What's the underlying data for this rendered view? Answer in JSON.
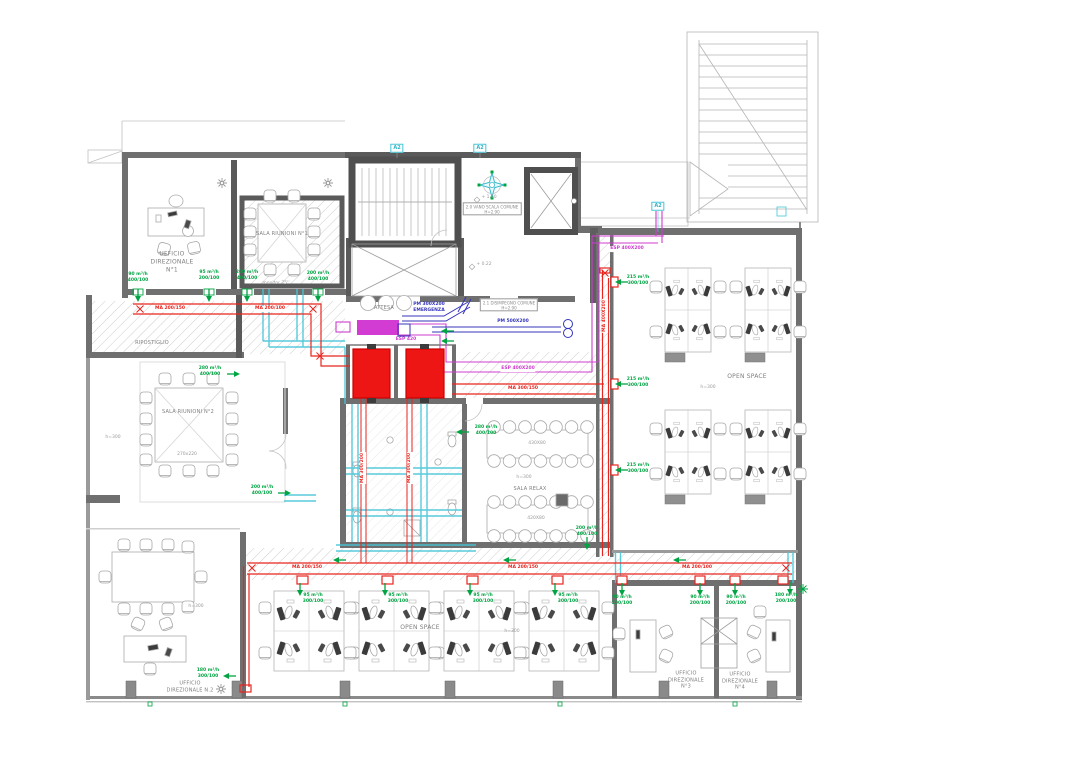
{
  "plan": {
    "rooms": {
      "ufficio_direzionale_1": "UFFICIO\nDIREZIONALE\nN°1",
      "sala_riunioni_1": "SALA RIUNIONI N°1",
      "ripostiglio": "RIPOSTIGLIO",
      "attesa": "ATTESA",
      "sala_riunioni_2": "SALA RIUNIONI N°2",
      "sala_relax": "SALA RELAX",
      "open_space": "OPEN SPACE",
      "ufficio_direzionale_2": "UFFICIO\nDIREZIONALE N.2",
      "ufficio_direzionale_3": "UFFICIO\nDIREZIONALE\nN°3",
      "ufficio_direzionale_4": "UFFICIO\nDIREZIONALE\nN°4"
    },
    "annotations": {
      "vano_scala_tag": "2.0 VANO SCALA COMUNE\nH=2.90",
      "disimpegno_tag": "2.1 DISIMPEGNO COMUNE\nH=2.90",
      "marker_a2": "A2",
      "level_up": "+ 1.50",
      "level_zero": "+ 0.22",
      "monitor": "monitor 75''",
      "table_riunioni2": "270x220",
      "table_relax_top": "430X80",
      "table_relax_bottom": "420X80",
      "ceiling_height": "h=300"
    },
    "duct_labels": {
      "ma_200_150": "MA 200/150",
      "ma_200_100": "MA 200/100",
      "ma_300_150": "MA 300/150",
      "ma_400_200": "MA 400X200",
      "ma_300_200": "MA 300/200",
      "pm_500_200": "PM 500X200",
      "pm_300_emergenza": "PM 300X200\nEMERGENZA",
      "esp_400_200": "ESP 400X200",
      "esp_420": "ESP 420"
    },
    "airflow_labels": [
      "90 m³/h\n400/100",
      "95 m³/h\n200/100",
      "200 m³/h\n400/100",
      "280 m³/h\n400/100",
      "215 m³/h\n300/100",
      "180 m³/h\n300/100",
      "95 m³/h\n300/100",
      "90 m³/h\n200/100",
      "180 m³/h\n200/100"
    ],
    "colors": {
      "supply_duct_red": "#e8251f",
      "return_duct_cyan": "#45c6d8",
      "exhaust_duct_magenta": "#cf3ccf",
      "fresh_air_duct_blue": "#3434bb",
      "airflow_green": "#00a443",
      "wall_gray": "#6f6f6f"
    }
  }
}
